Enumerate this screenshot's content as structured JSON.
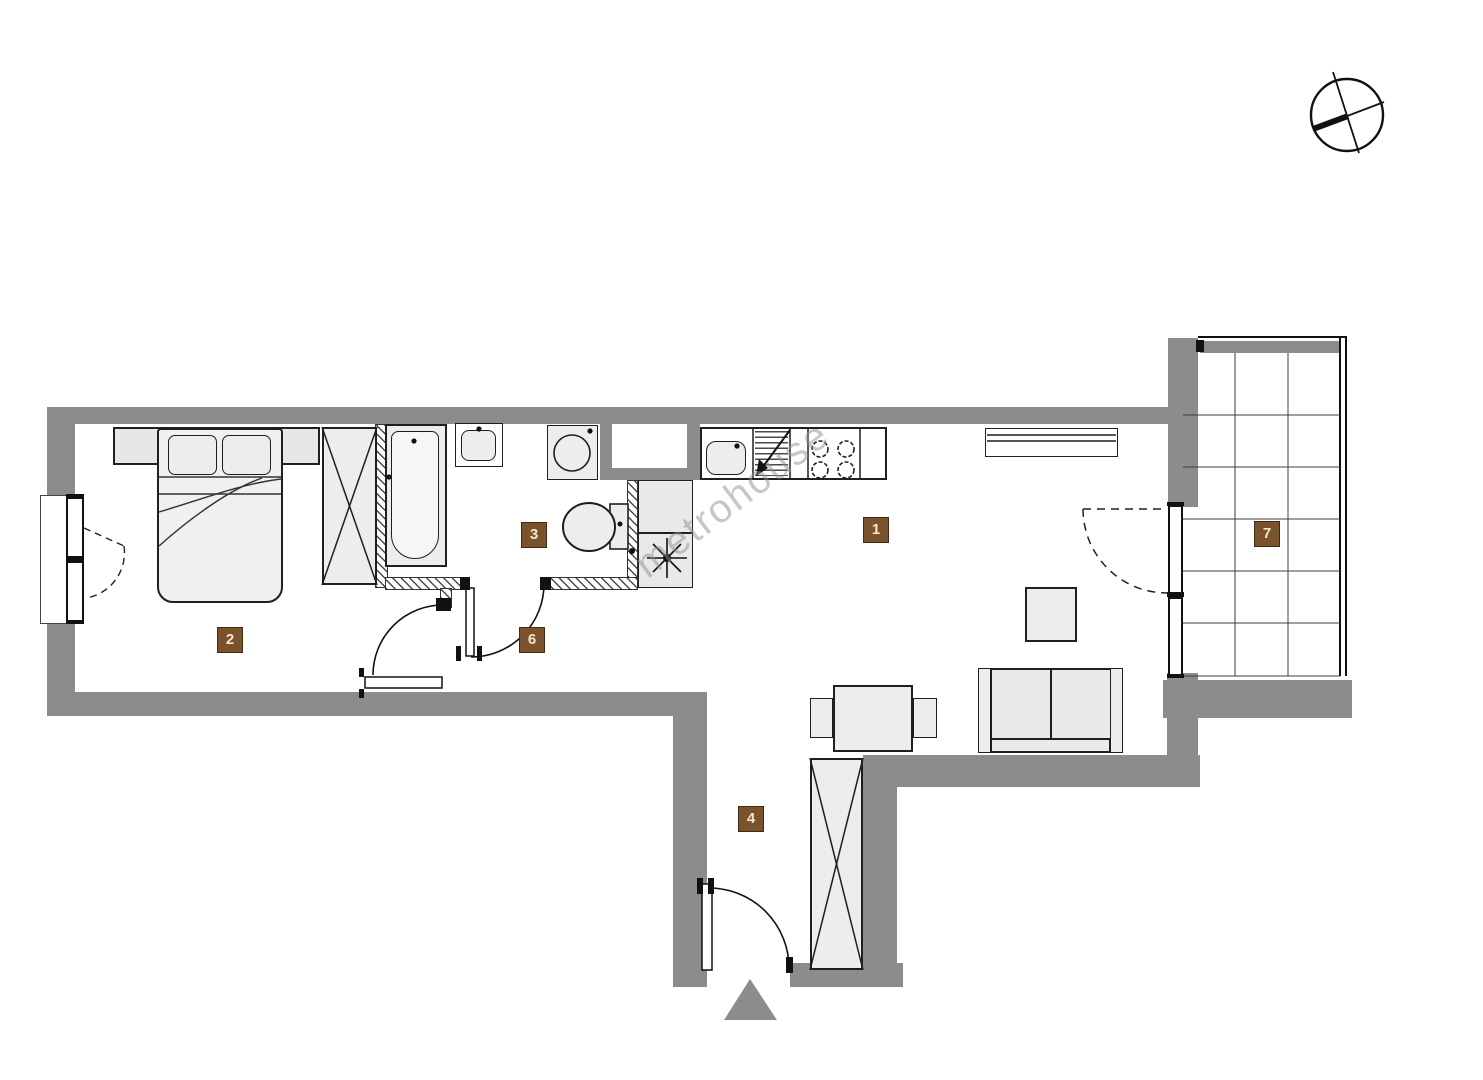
{
  "floorplan": {
    "watermark": "metrohouse",
    "colors": {
      "wall": "#8C8C8C",
      "line": "#1F1F1F",
      "furn": "#EDEDED",
      "label_bg": "#7A532D",
      "label_border": "#3F2A16",
      "label_text": "#F1E6D0",
      "watermark": "#909090"
    },
    "rooms": [
      {
        "number": "1",
        "name": "living-room-with-kitchenette"
      },
      {
        "number": "2",
        "name": "bedroom"
      },
      {
        "number": "3",
        "name": "bathroom"
      },
      {
        "number": "4",
        "name": "entrance-hall"
      },
      {
        "number": "6",
        "name": "corridor"
      },
      {
        "number": "7",
        "name": "balcony"
      }
    ],
    "icons": [
      "compass-icon",
      "entrance-arrow-icon",
      "ventilation-shaft-icon",
      "bed-icon",
      "wardrobe-icon",
      "bathtub-icon",
      "washbasin-icon",
      "washing-machine-icon",
      "toilet-icon",
      "kitchen-sink-icon",
      "dishwasher-icon",
      "stove-icon",
      "radiator-icon",
      "dining-table-icon",
      "chair-icon",
      "sofa-icon",
      "coffee-table-icon",
      "window-icon",
      "door-icon"
    ]
  }
}
